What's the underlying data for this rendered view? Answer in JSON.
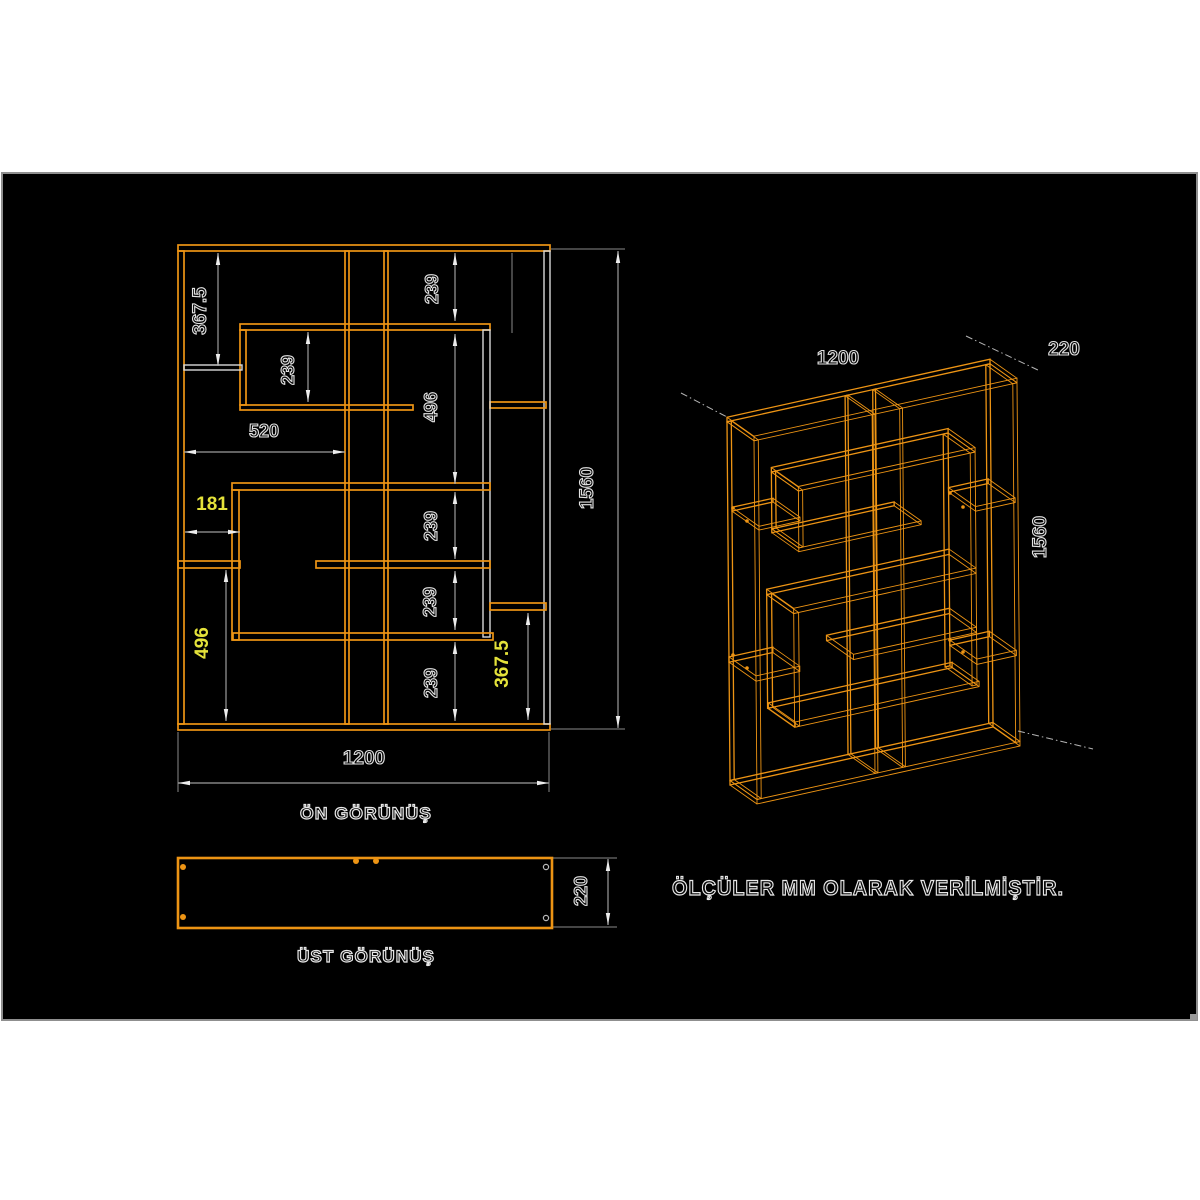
{
  "meta": {
    "units_note": "ÖLÇÜLER MM OLARAK VERİLMİŞTİR.",
    "note_pos": [
      672,
      895
    ]
  },
  "colors": {
    "background": "#ffffff",
    "canvas": "#000000",
    "canvas_border": "#8f8f8f",
    "panel_orange": "#ed9414",
    "panel_white": "#d9d9d9",
    "dim_line": "#9d9d9d",
    "ext_line": "#8a8a8a",
    "arrow": "#ececec",
    "accent_yellow": "#e4e23a",
    "leader": "#b4b4b4"
  },
  "canvas_rect": [
    2,
    173,
    1195,
    847
  ],
  "front_view": {
    "label": "ÖN GÖRÜNÜŞ",
    "label_pos": [
      366,
      819
    ],
    "overall_mm": {
      "width": 1200,
      "height": 1560
    },
    "panels": [
      {
        "name": "top-panel",
        "r": [
          178,
          245,
          372,
          6
        ],
        "c": "p"
      },
      {
        "name": "bottom-panel",
        "r": [
          178,
          724,
          372,
          6
        ],
        "c": "p"
      },
      {
        "name": "left-side-panel",
        "r": [
          178,
          251,
          6,
          473
        ],
        "c": "p"
      },
      {
        "name": "right-side-panel",
        "r": [
          544,
          251,
          6,
          473
        ],
        "c": "w"
      },
      {
        "name": "divider-1",
        "r": [
          345,
          251,
          4,
          473
        ],
        "c": "p"
      },
      {
        "name": "divider-2",
        "r": [
          384,
          251,
          4,
          473
        ],
        "c": "p"
      },
      {
        "name": "upper-box-top",
        "r": [
          240,
          324,
          250,
          6
        ],
        "c": "p"
      },
      {
        "name": "upper-box-left",
        "r": [
          240,
          330,
          6,
          75
        ],
        "c": "p"
      },
      {
        "name": "upper-box-bottom",
        "r": [
          240,
          405,
          173,
          5
        ],
        "c": "p"
      },
      {
        "name": "right-shelf-upper",
        "r": [
          490,
          402,
          56,
          6
        ],
        "c": "p"
      },
      {
        "name": "hanging-side",
        "r": [
          483,
          330,
          7,
          307
        ],
        "c": "w"
      },
      {
        "name": "lower-box-top",
        "r": [
          232,
          483,
          258,
          7
        ],
        "c": "p"
      },
      {
        "name": "lower-box-left",
        "r": [
          232,
          490,
          7,
          150
        ],
        "c": "p"
      },
      {
        "name": "lower-box-bottom",
        "r": [
          233,
          633,
          260,
          7
        ],
        "c": "p"
      },
      {
        "name": "mid-shelf-left",
        "r": [
          178,
          561,
          62,
          7
        ],
        "c": "p"
      },
      {
        "name": "mid-shelf-right",
        "r": [
          316,
          561,
          174,
          7
        ],
        "c": "p"
      },
      {
        "name": "left-short-shelf",
        "r": [
          184,
          365,
          58,
          5
        ],
        "c": "w"
      },
      {
        "name": "right-shelf-lower",
        "r": [
          490,
          603,
          56,
          7
        ],
        "c": "p"
      }
    ],
    "dims": [
      {
        "t": "367.5",
        "c": "w",
        "o": "v",
        "l": [
          218,
          253,
          218,
          366
        ],
        "p": [
          206,
          311
        ]
      },
      {
        "t": "239",
        "c": "w",
        "o": "v",
        "l": [
          308,
          332,
          308,
          402
        ],
        "p": [
          294,
          370
        ]
      },
      {
        "t": "239",
        "c": "w",
        "o": "v",
        "l": [
          455,
          253,
          455,
          321
        ],
        "p": [
          438,
          289
        ]
      },
      {
        "t": "496",
        "c": "w",
        "o": "v",
        "l": [
          455,
          334,
          455,
          484
        ],
        "p": [
          437,
          407
        ]
      },
      {
        "t": "239",
        "c": "w",
        "o": "v",
        "l": [
          455,
          492,
          455,
          559
        ],
        "p": [
          437,
          526
        ]
      },
      {
        "t": "239",
        "c": "w",
        "o": "v",
        "l": [
          455,
          571,
          455,
          630
        ],
        "p": [
          436,
          602
        ]
      },
      {
        "t": "239",
        "c": "w",
        "o": "v",
        "l": [
          455,
          642,
          455,
          721
        ],
        "p": [
          437,
          683
        ]
      },
      {
        "t": "367.5",
        "c": "y",
        "o": "v",
        "l": [
          528,
          613,
          528,
          720
        ],
        "p": [
          508,
          664
        ]
      },
      {
        "t": "496",
        "c": "y",
        "o": "v",
        "l": [
          226,
          570,
          226,
          721
        ],
        "p": [
          208,
          643
        ]
      },
      {
        "t": "520",
        "c": "w",
        "o": "h",
        "l": [
          184,
          452,
          345,
          452
        ],
        "p": [
          264,
          437
        ]
      },
      {
        "t": "181",
        "c": "y",
        "o": "h",
        "l": [
          185,
          532,
          240,
          532
        ],
        "p": [
          212,
          510
        ]
      },
      {
        "t": "1560",
        "c": "w",
        "o": "v",
        "l": [
          618,
          251,
          618,
          728
        ],
        "p": [
          593,
          488
        ]
      },
      {
        "t": "1200",
        "c": "w",
        "o": "h",
        "l": [
          178,
          783,
          549,
          783
        ],
        "p": [
          364,
          764
        ]
      }
    ],
    "ext_lines": [
      [
        551,
        249,
        625,
        249
      ],
      [
        551,
        729,
        625,
        729
      ],
      [
        178,
        732,
        178,
        792
      ],
      [
        549,
        732,
        549,
        792
      ],
      [
        512,
        253,
        512,
        333
      ]
    ]
  },
  "top_view": {
    "label": "ÜST GÖRÜNÜŞ",
    "label_pos": [
      366,
      962
    ],
    "rect": [
      178,
      858,
      374,
      70
    ],
    "depth_mm": 220,
    "pin_dots": [
      [
        183,
        867
      ],
      [
        183,
        917
      ],
      [
        356,
        861
      ],
      [
        376,
        861
      ]
    ],
    "hole_circles": [
      [
        546,
        867
      ],
      [
        546,
        918
      ]
    ],
    "dim": {
      "t": "220",
      "c": "w",
      "o": "v",
      "l": [
        608,
        859,
        608,
        925
      ],
      "p": [
        587,
        891
      ]
    },
    "ext_lines": [
      [
        553,
        858,
        617,
        858
      ],
      [
        553,
        927,
        617,
        927
      ]
    ]
  },
  "iso_view": {
    "origin": [
      727,
      418
    ],
    "u_vec": [
      263,
      -58
    ],
    "v_vec": [
      3,
      367
    ],
    "depth_vec": [
      27,
      19
    ],
    "front_size": [
      372,
      484
    ],
    "labels": [
      {
        "t": "1200",
        "p": [
          838,
          364
        ],
        "rot": 0
      },
      {
        "t": "220",
        "p": [
          1064,
          355
        ],
        "rot": 0
      },
      {
        "t": "1560",
        "p": [
          1046,
          537
        ],
        "rot": -90
      }
    ],
    "leaders": [
      [
        681,
        393,
        727,
        417
      ],
      [
        966,
        336,
        1040,
        371
      ],
      [
        1018,
        731,
        1093,
        749
      ]
    ],
    "dots": [
      [
        733,
        508
      ],
      [
        747,
        521
      ],
      [
        733,
        655
      ],
      [
        747,
        668
      ],
      [
        950,
        493
      ],
      [
        963,
        507
      ],
      [
        950,
        640
      ],
      [
        963,
        652
      ]
    ]
  }
}
